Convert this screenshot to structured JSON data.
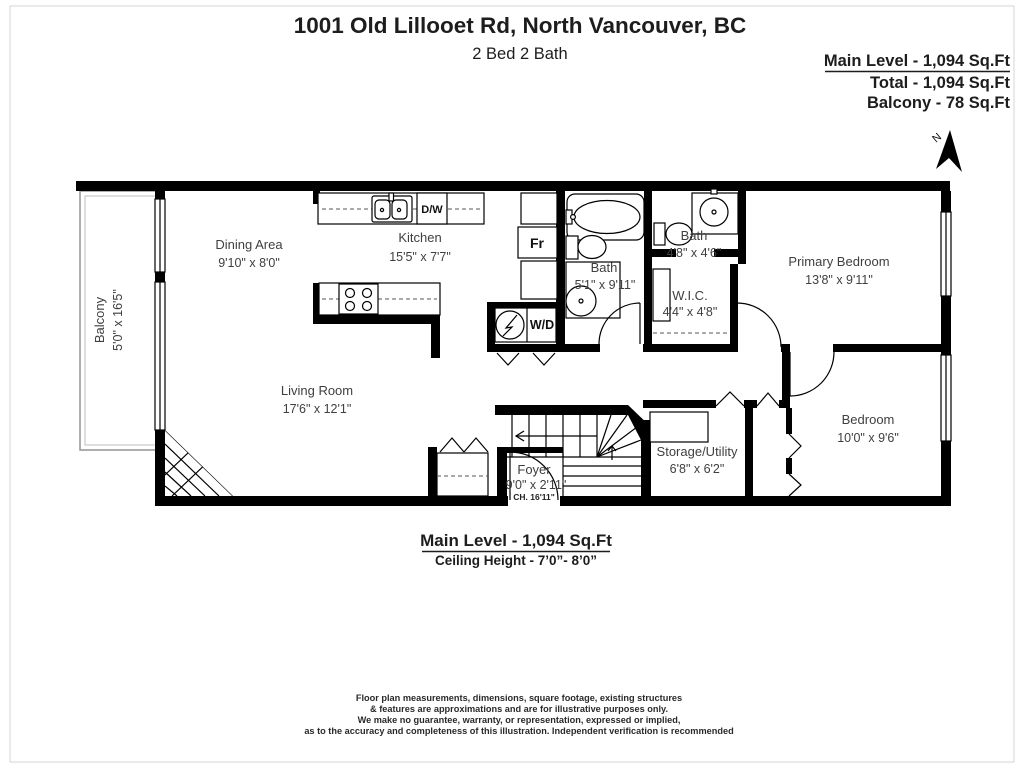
{
  "header": {
    "title": "1001 Old Lillooet Rd, North Vancouver, BC",
    "subtitle": "2 Bed 2 Bath"
  },
  "stats": {
    "main_level": "Main Level - 1,094 Sq.Ft",
    "total": "Total - 1,094 Sq.Ft",
    "balcony": "Balcony - 78 Sq.Ft"
  },
  "compass": {
    "north": "N"
  },
  "rooms": {
    "balcony": {
      "name": "Balcony",
      "dims": "5'0\" x 16'5\""
    },
    "dining": {
      "name": "Dining Area",
      "dims": "9'10\" x 8'0\""
    },
    "kitchen": {
      "name": "Kitchen",
      "dims": "15'5\" x 7'7\""
    },
    "living": {
      "name": "Living Room",
      "dims": "17'6\" x 12'1\""
    },
    "bath_main": {
      "name": "Bath",
      "dims": "5'1\" x 9'11\""
    },
    "bath_ensuite": {
      "name": "Bath",
      "dims": "4'8\" x 4'6\""
    },
    "wic": {
      "name": "W.I.C.",
      "dims": "4'4\" x 4'8\""
    },
    "primary_bedroom": {
      "name": "Primary Bedroom",
      "dims": "13'8\" x 9'11\""
    },
    "bedroom": {
      "name": "Bedroom",
      "dims": "10'0\" x 9'6\""
    },
    "storage": {
      "name": "Storage/Utility",
      "dims": "6'8\" x 6'2\""
    },
    "foyer": {
      "name": "Foyer",
      "dims": "9'0\" x 2'11\"",
      "ceiling": "CH. 16'11\""
    }
  },
  "appliances": {
    "dishwasher": "D/W",
    "fridge": "Fr",
    "washer_dryer": "W/D"
  },
  "footer": {
    "main_level": "Main Level - 1,094 Sq.Ft",
    "ceiling": "Ceiling Height - 7’0”- 8’0”"
  },
  "disclaimer": {
    "lines": [
      "Floor plan measurements, dimensions, square footage, existing structures",
      "& features are approximations and are for illustrative purposes only.",
      "We make no guarantee, warranty, or representation, expressed or implied,",
      "as to the accuracy and completeness of this illustration. Independent verification is recommended"
    ]
  }
}
